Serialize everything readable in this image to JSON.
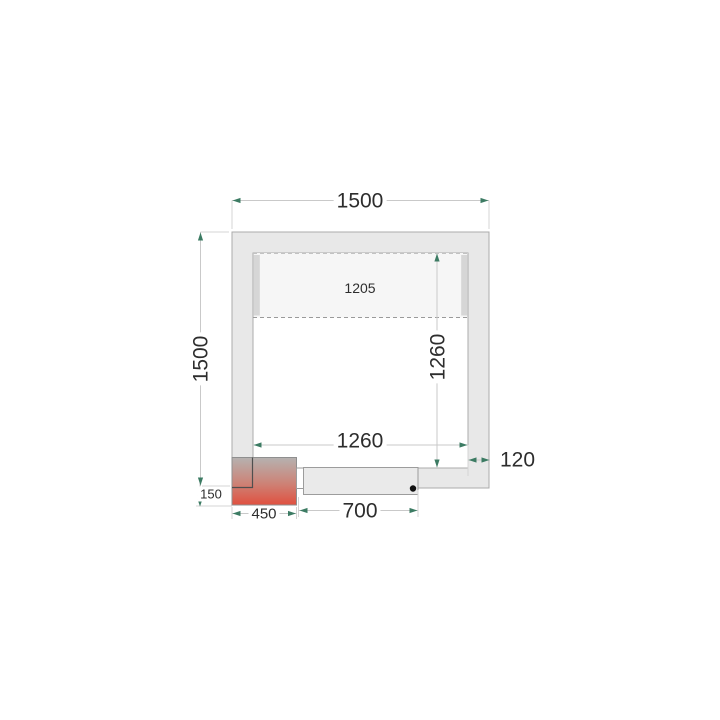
{
  "drawing": {
    "type": "cold-room-floor-plan",
    "dimensions": {
      "overall_width": "1500",
      "overall_height": "1500",
      "interior_width": "1260",
      "interior_height": "1260",
      "panel_length": "1205",
      "wall_thickness": "120",
      "door_opening": "700",
      "unit_width": "450",
      "unit_offset": "150"
    },
    "colors": {
      "background": "#ffffff",
      "wall_fill": "#e8e8e8",
      "wall_stroke": "#ababab",
      "panel_fill": "#f6f6f6",
      "panel_cap": "#d6d6d6",
      "dash_stroke": "#9a9a9a",
      "dash_stroke_light": "#c2c2c2",
      "dim_line": "#c9c9c9",
      "ext_line": "#d4d4d4",
      "arrow": "#3c7b63",
      "text": "#2d2d2d",
      "unit_gradient_top": "#b5b2b0",
      "unit_gradient_mid": "#cd8276",
      "unit_gradient_bottom": "#e0503f",
      "unit_stroke": "#8f8f8f",
      "corner_stroke": "#4f4f4f",
      "door_fill": "#eaeaea",
      "door_stroke": "#9c9c9c",
      "dot": "#111111"
    }
  }
}
